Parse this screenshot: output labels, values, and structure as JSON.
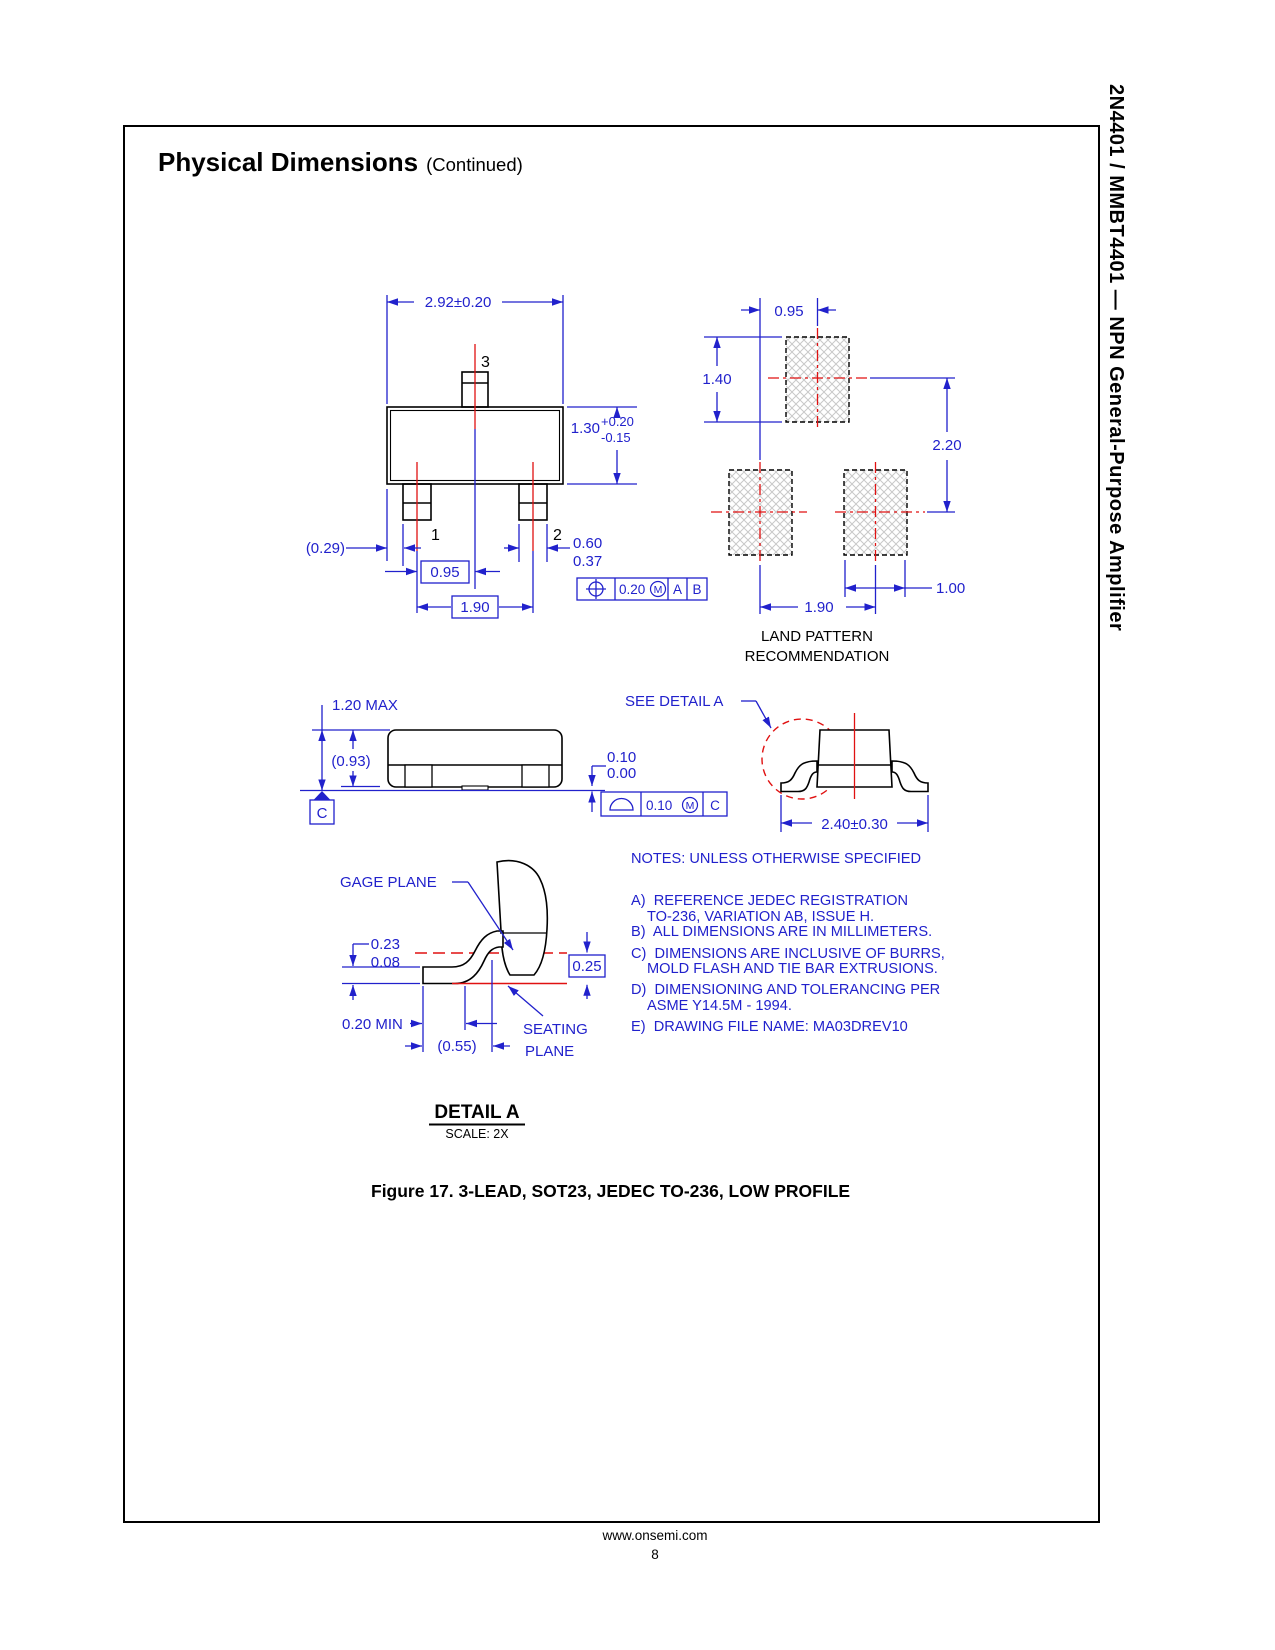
{
  "header": {
    "title": "Physical Dimensions",
    "continued": "(Continued)"
  },
  "sidebar": {
    "vertical_title": "2N4401 / MMBT4401 — NPN General-Purpose Amplifier"
  },
  "top_view": {
    "dim_overall_width": "2.92±0.20",
    "pin_3": "3",
    "pin_1": "1",
    "pin_2": "2",
    "dim_body_height": "1.30",
    "dim_body_height_tol_plus": "+0.20",
    "dim_body_height_tol_minus": "-0.15",
    "dim_edge_to_lead": "(0.29)",
    "dim_lead_width_max": "0.60",
    "dim_lead_width_min": "0.37",
    "dim_pitch_half": "0.95",
    "dim_pitch_full": "1.90",
    "fcf_tolerance": "0.20",
    "fcf_modifier": "M",
    "fcf_datum_a": "A",
    "fcf_datum_b": "B"
  },
  "land_pattern": {
    "dim_offset": "0.95",
    "dim_pad_height": "1.40",
    "dim_row_pitch": "2.20",
    "dim_col_pitch": "1.90",
    "dim_pad_width": "1.00",
    "label_line1": "LAND PATTERN",
    "label_line2": "RECOMMENDATION"
  },
  "side_view": {
    "dim_height": "1.20 MAX",
    "dim_body": "(0.93)",
    "datum": "C",
    "dim_standoff_max": "0.10",
    "dim_standoff_min": "0.00",
    "fcf_tolerance": "0.10",
    "fcf_modifier": "M",
    "fcf_datum": "C"
  },
  "end_view": {
    "callout": "SEE DETAIL A",
    "dim_width": "2.40±0.30"
  },
  "detail_a": {
    "gage_plane": "GAGE PLANE",
    "dim_thickness_max": "0.23",
    "dim_thickness_min": "0.08",
    "dim_gage_to_seat": "0.25",
    "dim_foot": "0.20 MIN",
    "dim_foot_ref": "(0.55)",
    "seating_line1": "SEATING",
    "seating_line2": "PLANE",
    "title": "DETAIL A",
    "scale": "SCALE: 2X"
  },
  "notes": {
    "header": "NOTES: UNLESS OTHERWISE SPECIFIED",
    "lines": [
      "A)  REFERENCE JEDEC REGISTRATION",
      "TO-236, VARIATION AB, ISSUE H.",
      "B)  ALL DIMENSIONS ARE IN MILLIMETERS.",
      "C)  DIMENSIONS ARE INCLUSIVE OF BURRS,",
      "MOLD FLASH AND TIE BAR EXTRUSIONS.",
      "D)  DIMENSIONING AND TOLERANCING PER",
      "ASME Y14.5M - 1994.",
      "E)  DRAWING FILE NAME: MA03DREV10"
    ]
  },
  "caption": "Figure 17. 3-LEAD, SOT23, JEDEC TO-236, LOW PROFILE",
  "footer": {
    "url": "www.onsemi.com",
    "page_number": "8"
  },
  "colors": {
    "dimension": "#2121cc",
    "centerline": "#e01111",
    "outline": "#000000",
    "hatch": "#c8c8c8"
  }
}
